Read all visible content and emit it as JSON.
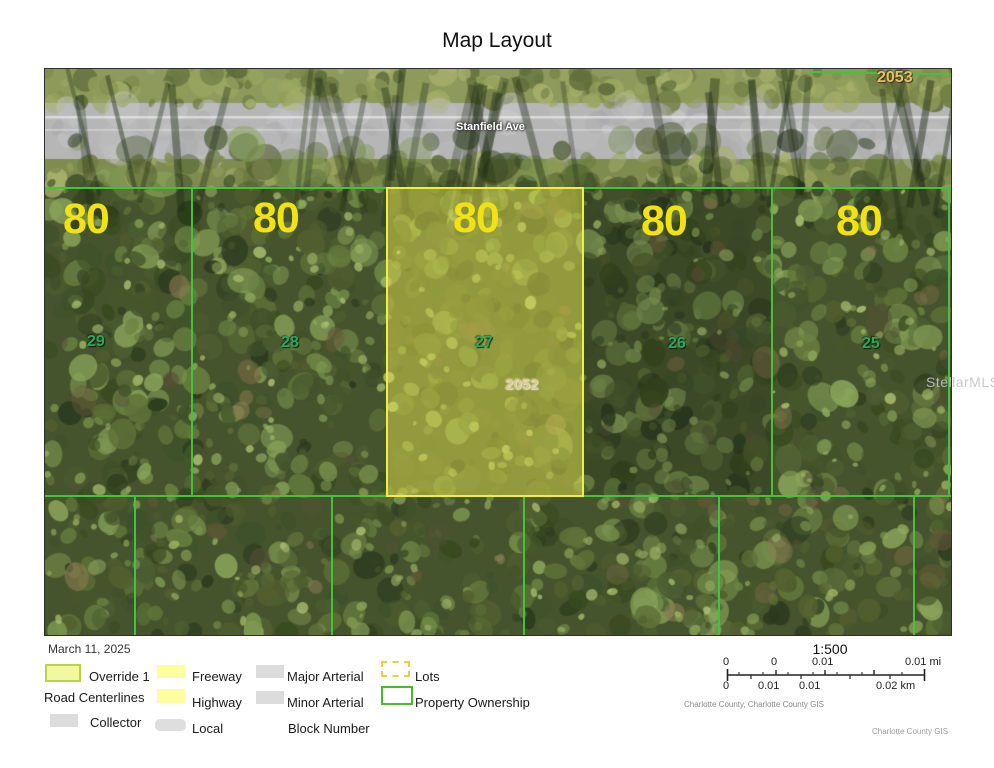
{
  "title": "Map Layout",
  "map": {
    "street_label": "Stanfield Ave",
    "block_number_top": "2053",
    "block_number_highlight": "2052",
    "parcels": [
      {
        "number": "29",
        "width_label": "80",
        "highlighted": false
      },
      {
        "number": "28",
        "width_label": "80",
        "highlighted": false
      },
      {
        "number": "27",
        "width_label": "80",
        "highlighted": true
      },
      {
        "number": "26",
        "width_label": "80",
        "highlighted": false
      },
      {
        "number": "25",
        "width_label": "80",
        "highlighted": false
      }
    ],
    "watermark": "StellarMLS"
  },
  "legend": {
    "date": "March 11, 2025",
    "override": "Override 1",
    "road_centerlines": "Road Centerlines",
    "collector": "Collector",
    "freeway": "Freeway",
    "highway": "Highway",
    "local": "Local",
    "major_arterial": "Major Arterial",
    "minor_arterial": "Minor Arterial",
    "block_number": "Block Number",
    "lots": "Lots",
    "property_ownership": "Property Ownership"
  },
  "scale": {
    "ratio": "1:500",
    "mi": [
      "0",
      "0",
      "0.01",
      "0.01 mi"
    ],
    "km": [
      "0",
      "0.01",
      "0.01",
      "0.02 km"
    ],
    "attribution": "Charlotte County, Charlotte County GIS",
    "credit": "Charlotte County GIS"
  },
  "colors": {
    "parcel_line": "#46c23a",
    "highlight_border": "#f0ee45",
    "highlight_fill": "#e2e050",
    "lot_width_number": "#f2e211",
    "parcel_number": "#2aa85c",
    "block_number": "#e2c070",
    "legend_yellow": "#feff9e",
    "legend_gray": "#dcdcdd",
    "override_fill": "#f2f7a2"
  }
}
